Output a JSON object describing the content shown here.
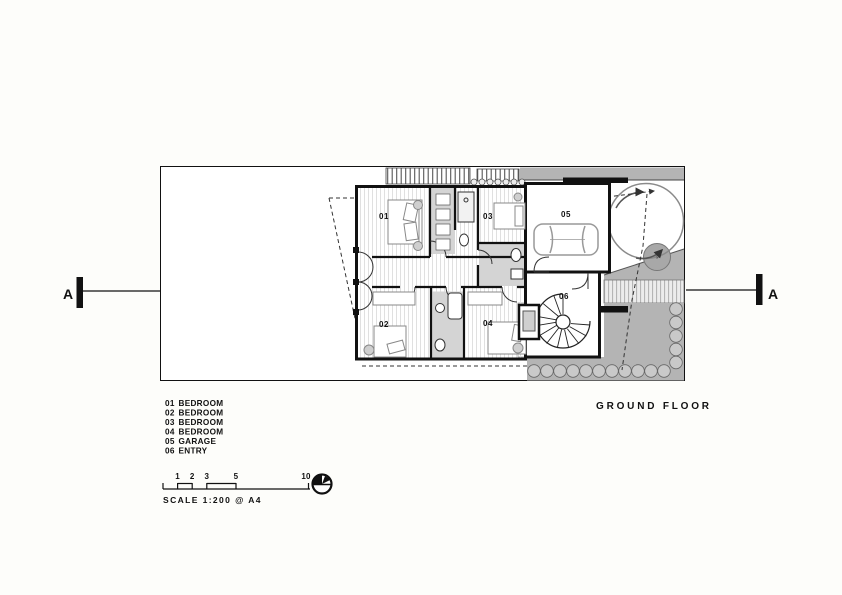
{
  "drawing": {
    "title": "GROUND FLOOR",
    "rooms": [
      {
        "num": "01",
        "label": "BEDROOM"
      },
      {
        "num": "02",
        "label": "BEDROOM"
      },
      {
        "num": "03",
        "label": "BEDROOM"
      },
      {
        "num": "04",
        "label": "BEDROOM"
      },
      {
        "num": "05",
        "label": "GARAGE"
      },
      {
        "num": "06",
        "label": "ENTRY"
      }
    ],
    "section_markers": {
      "left": "A",
      "right": "A"
    },
    "scale": {
      "label": "SCALE 1:200 @ A4",
      "ticks": [
        "1",
        "2",
        "3",
        "5",
        "10"
      ]
    },
    "colors": {
      "line": "#111111",
      "site_gray": "#b4b4b4",
      "wet_area_gray": "#d4d4d4",
      "paper": "#fdfdfa"
    }
  }
}
